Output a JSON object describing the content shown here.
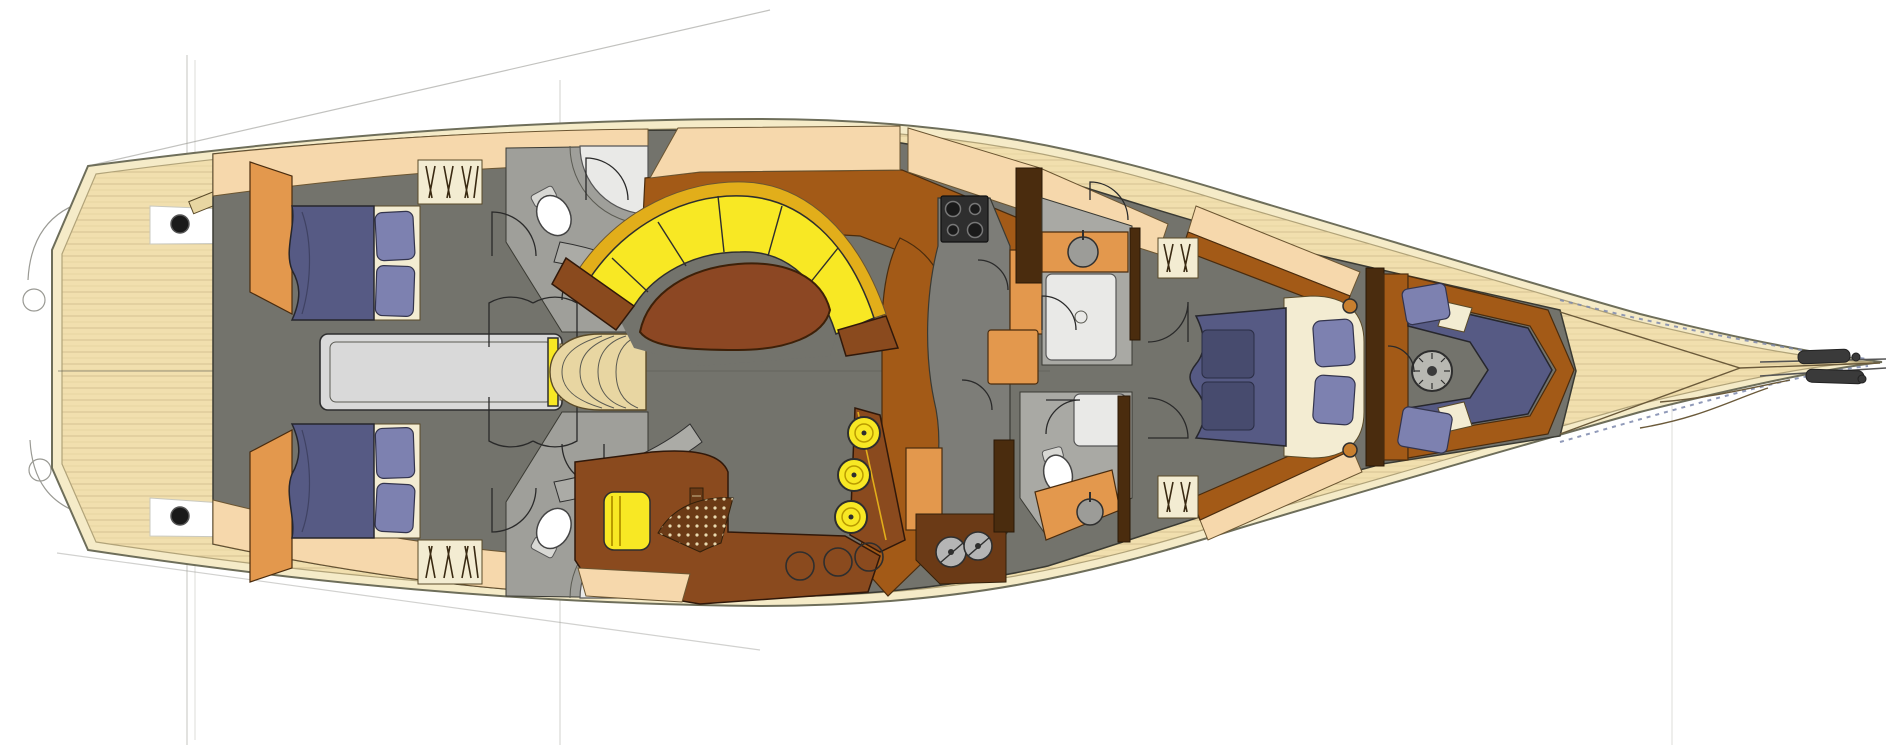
{
  "figure": {
    "kind": "yacht-interior-deck-plan",
    "orientation": "bow-right",
    "background": "#ffffff"
  },
  "palette": {
    "hull_cream": "#f5ebc8",
    "hull_line": "#6e6e5a",
    "teak": "#f1dfae",
    "teak_line": "#d5c292",
    "teak_edge": "#b1a379",
    "deck_peach": "#f6d8ac",
    "orange": "#e3984d",
    "wood": "#a35a17",
    "wood_dark": "#6b3a16",
    "mahogany": "#8c4723",
    "desk_brown": "#8a4a1e",
    "sole": "#73736c",
    "partition": "#ababa6",
    "bath": "#a9a9a4",
    "shower": "#e9e9e7",
    "engine_gray": "#d9d9d9",
    "yellow": "#f8e824",
    "gold": "#e2ae1a",
    "navy": "#565a84",
    "navy_dark": "#474b6e",
    "pillow": "#7d81b0",
    "cream": "#f3ecd2",
    "tan": "#e8d6a2",
    "stove": "#2e2e2e",
    "post": "#4a2c0e",
    "steel": "#b5b5b5",
    "guide": "#cfcfca",
    "rail_blue": "#7c88ad"
  },
  "items": {
    "stools": [
      {
        "cx": 864,
        "cy": 433
      },
      {
        "cx": 854,
        "cy": 475
      },
      {
        "cx": 851,
        "cy": 517
      }
    ],
    "stool_radius": 16,
    "burners": [
      {
        "cx": 953,
        "cy": 209,
        "r": 7.5
      },
      {
        "cx": 975,
        "cy": 209,
        "r": 5.5
      },
      {
        "cx": 953,
        "cy": 230,
        "r": 5.5
      },
      {
        "cx": 975,
        "cy": 230,
        "r": 7.5
      }
    ],
    "bar_rings": [
      {
        "cx": 800,
        "cy": 566,
        "r": 14
      },
      {
        "cx": 838,
        "cy": 562,
        "r": 14
      },
      {
        "cx": 869,
        "cy": 557,
        "r": 14
      }
    ],
    "machines": [
      {
        "cx": 951,
        "cy": 552,
        "r": 15
      },
      {
        "cx": 978,
        "cy": 546,
        "r": 14
      }
    ],
    "bollards": [
      {
        "cx": 180,
        "cy": 224,
        "r": 9
      },
      {
        "cx": 180,
        "cy": 516,
        "r": 9
      }
    ],
    "basins": [
      {
        "cx": 1083,
        "cy": 252,
        "r": 15
      },
      {
        "cx": 1090,
        "cy": 512,
        "r": 13
      }
    ]
  }
}
